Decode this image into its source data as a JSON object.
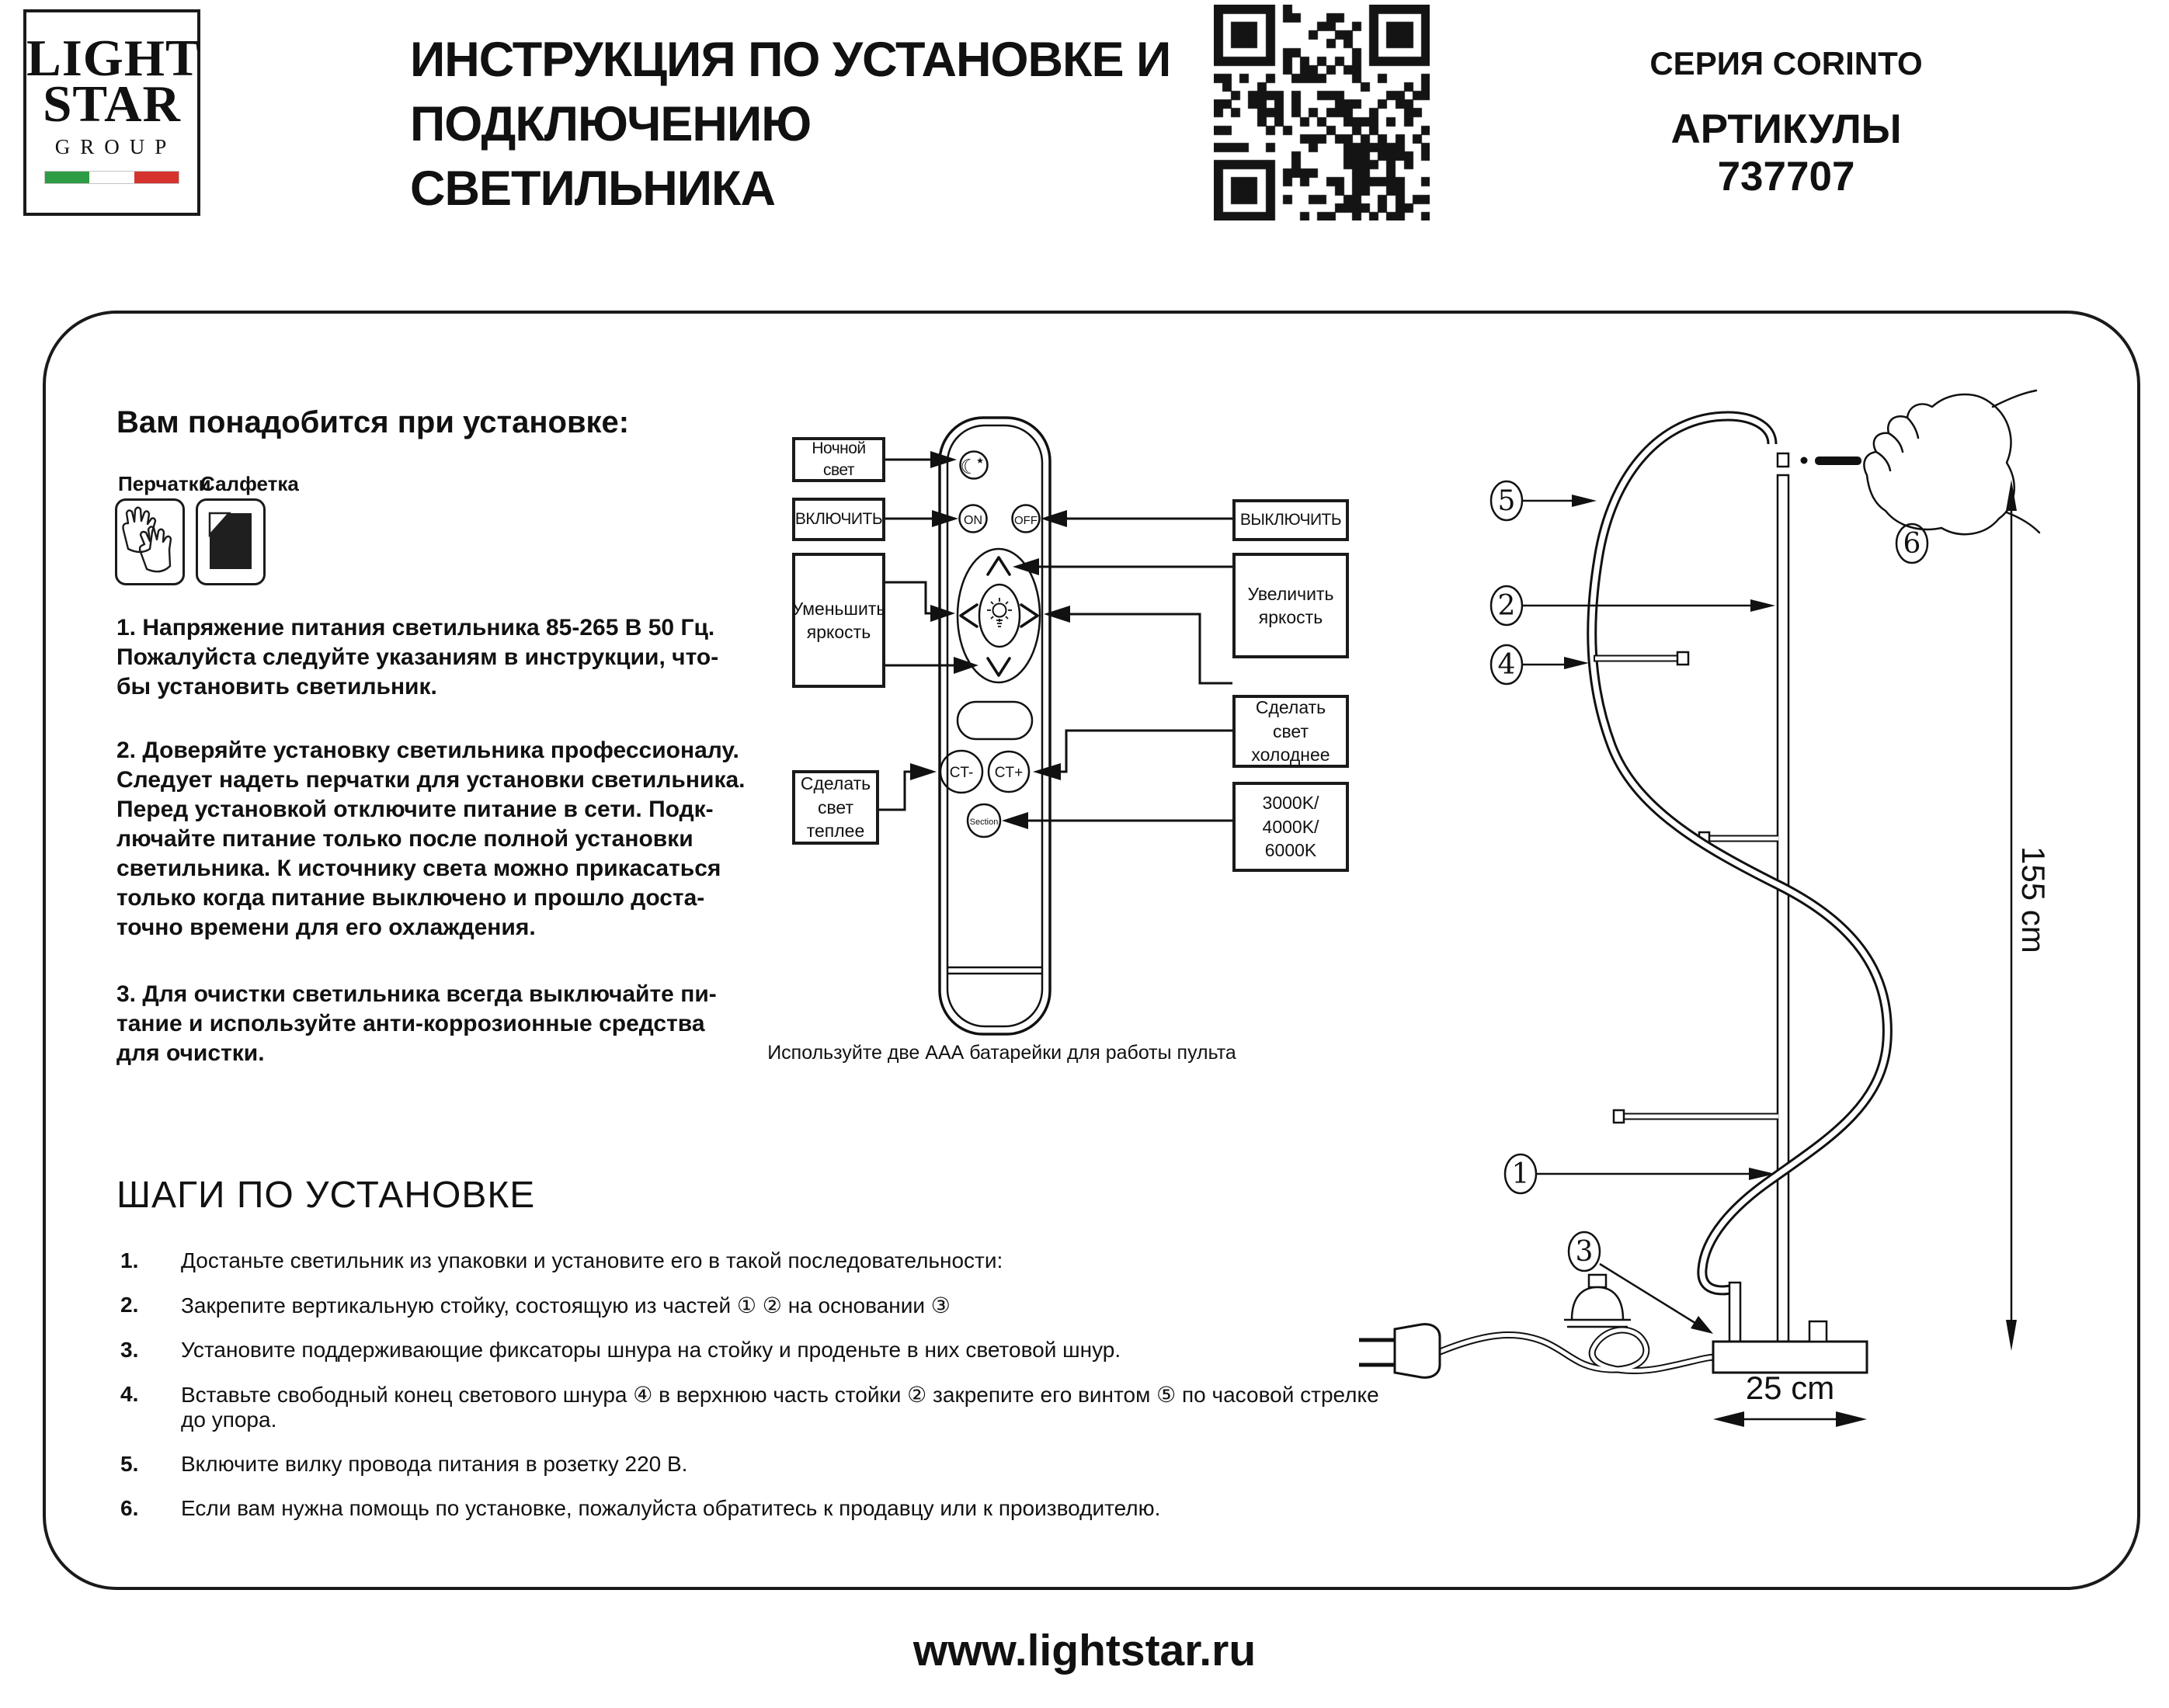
{
  "header": {
    "logo": {
      "line1": "LIGHT",
      "line2": "STAR",
      "line3": "GROUP"
    },
    "title": [
      "ИНСТРУКЦИЯ ПО УСТАНОВКЕ И",
      "ПОДКЛЮЧЕНИЮ СВЕТИЛЬНИКА"
    ],
    "series": "СЕРИЯ CORINTO",
    "articles": "АРТИКУЛЫ 737707"
  },
  "colors": {
    "flag_green": "#2e9b45",
    "flag_white": "#ffffff",
    "flag_red": "#d6332f",
    "ink": "#111111"
  },
  "needs": {
    "heading": "Вам понадобится при установке:",
    "tool1": "Перчатки",
    "tool2": "Салфетка"
  },
  "safety": {
    "p1": [
      "1. Напряжение питания светильника 85-265 В 50 Гц.",
      "Пожалуйста следуйте указаниям в инструкции, что-",
      "бы установить светильник."
    ],
    "p2": [
      "2. Доверяйте установку светильника профессионалу.",
      "Следует надеть перчатки для установки светильника.",
      "Перед установкой отключите питание в сети. Подк-",
      "лючайте питание только после полной установки",
      "светильника. К источнику света можно прикасаться",
      "только когда питание выключено и прошло доста-",
      "точно времени для его охлаждения."
    ],
    "p3": [
      "3. Для очистки светильника всегда выключайте пи-",
      "тание и используйте анти-коррозионные средства",
      "для очистки."
    ]
  },
  "remote": {
    "labels": {
      "night": "Ночной свет",
      "turn_on": "ВКЛЮЧИТЬ",
      "dim": [
        "Уменьшить",
        "яркость"
      ],
      "warm": [
        "Сделать",
        "свет",
        "теплее"
      ],
      "turn_off": "ВЫКЛЮЧИТЬ",
      "brighten": [
        "Увеличить",
        "яркость"
      ],
      "cooler": [
        "Сделать",
        "свет",
        "холоднее"
      ],
      "kelvin": [
        "3000K/",
        "4000K/",
        "6000K"
      ]
    },
    "buttons": {
      "on": "ON",
      "off": "OFF",
      "ct_minus": "CT-",
      "ct_plus": "CT+",
      "section": "Section"
    },
    "caption": "Используйте две ААА батарейки для работы пульта"
  },
  "steps": {
    "heading": "ШАГИ ПО УСТАНОВКЕ",
    "items": [
      {
        "num": "1.",
        "text": "Достаньте светильник из упаковки и установите его в такой последовательности:"
      },
      {
        "num": "2.",
        "text": "Закрепите вертикальную стойку, состоящую из частей ①  ②   на основании ③"
      },
      {
        "num": "3.",
        "text": "Установите поддерживающие фиксаторы шнура на стойку и проденьте в них световой шнур."
      },
      {
        "num": "4.",
        "text": "Вставьте свободный конец светового шнура ④ в верхнюю часть стойки ②  закрепите его винтом ⑤ по часовой стрелке до упора."
      },
      {
        "num": "5.",
        "text": "Включите вилку провода питания в розетку 220 В."
      },
      {
        "num": "6.",
        "text": "Если вам нужна помощь по установке, пожалуйста обратитесь к продавцу или к производителю."
      }
    ]
  },
  "diagram": {
    "callouts": {
      "c1": "1",
      "c2": "2",
      "c3": "3",
      "c4": "4",
      "c5": "5",
      "c6": "6"
    },
    "height_label": "155 cm",
    "width_label": "25 cm"
  },
  "footer": {
    "website": "www.lightstar.ru"
  }
}
